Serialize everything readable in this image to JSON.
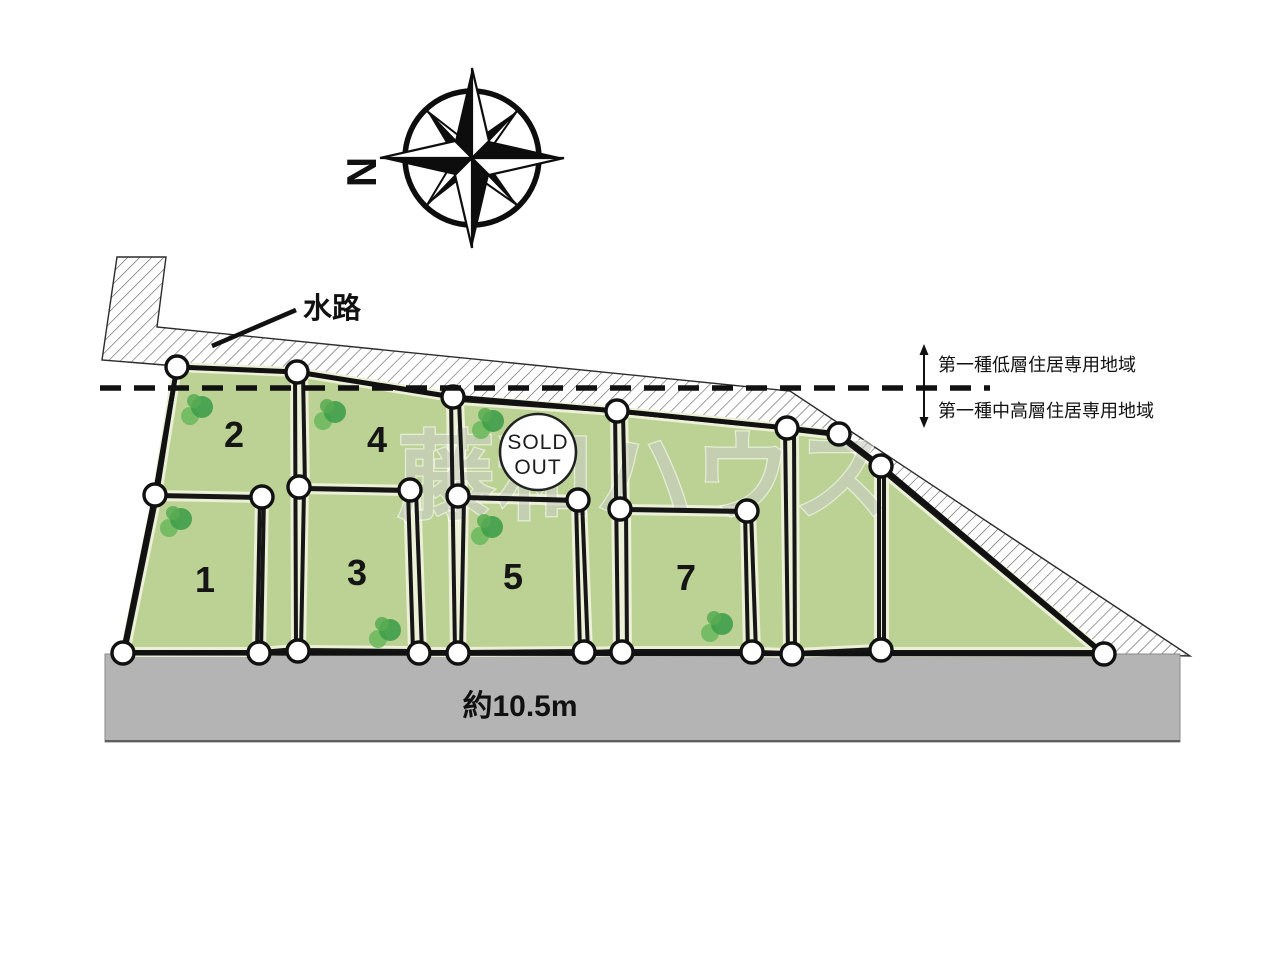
{
  "compass": {
    "north_label": "N"
  },
  "annotations": {
    "waterway_label": "水路",
    "zoning_upper": "第一種低層住居専用地域",
    "zoning_lower": "第一種中高層住居専用地域",
    "road_width_label": "約10.5m"
  },
  "watermark": "藤和ハウス",
  "sold_out_badge": {
    "line1": "SOLD",
    "line2": "OUT"
  },
  "lots": {
    "n1": "1",
    "n2": "2",
    "n3": "3",
    "n4": "4",
    "n5": "5",
    "n7": "7"
  },
  "colors": {
    "lot_green": "#bcd294",
    "lot_inner_edge": "#ecf0d6",
    "road_gray": "#b4b4b4",
    "outline_black": "#161616",
    "tree_green_dark": "#3f9e4a",
    "tree_green_light": "#6db95e"
  }
}
